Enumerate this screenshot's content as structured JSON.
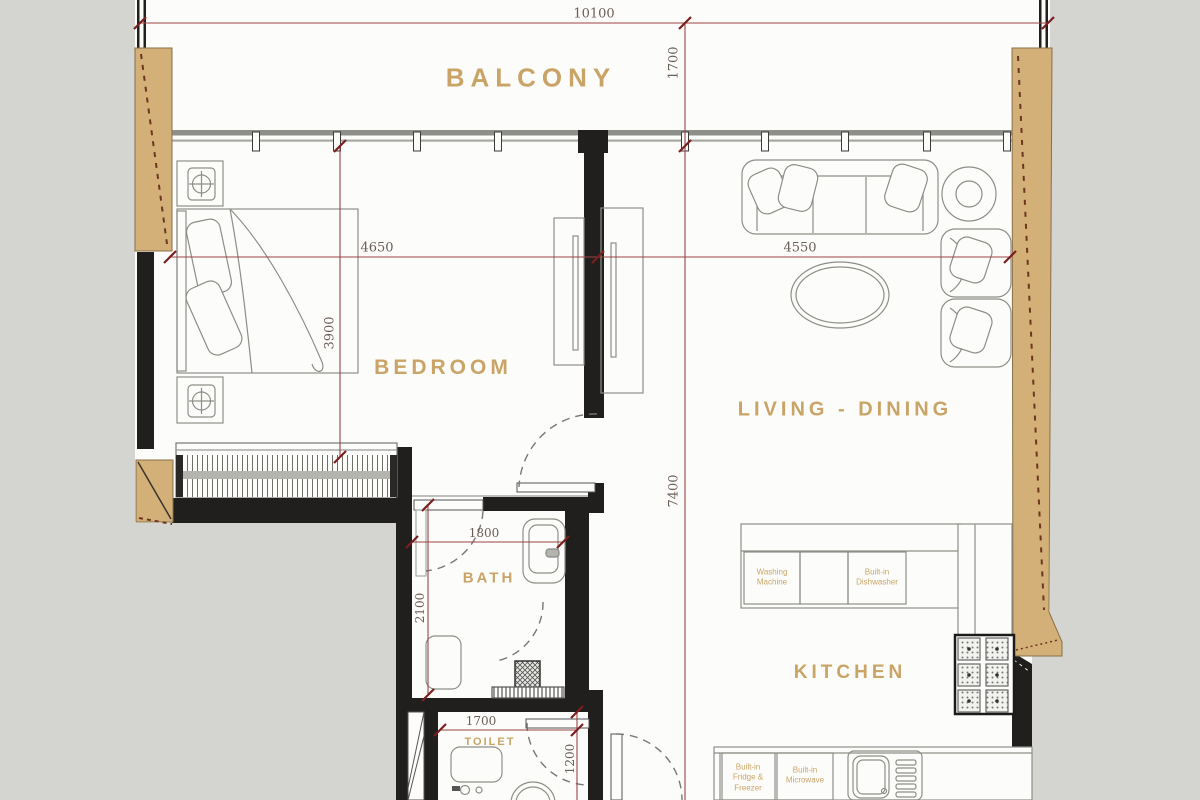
{
  "plan": {
    "rooms": {
      "balcony": "BALCONY",
      "bedroom": "BEDROOM",
      "living_dining": "LIVING - DINING",
      "bath": "BATH",
      "toilet": "TOILET",
      "kitchen": "KITCHEN"
    },
    "dimensions": {
      "overall_width": "10100",
      "balcony_depth": "1700",
      "bedroom_width": "4650",
      "bedroom_depth": "3900",
      "living_width": "4550",
      "unit_depth": "7400",
      "bath_width": "1800",
      "bath_depth": "2100",
      "toilet_width": "1700",
      "toilet_depth": "1200"
    },
    "appliances": {
      "washing_machine": "Washing Machine",
      "dishwasher": "Built-in Dishwasher",
      "fridge_freezer": "Built-in Fridge & Freezer",
      "microwave": "Built-in Microwave"
    },
    "colors": {
      "background": "#d4d4d0",
      "paper": "#fcfcfa",
      "wall_black": "#211f1d",
      "wood_tan": "#d2b078",
      "label_gold": "#c9a466",
      "dimension_red": "#9c4444",
      "dimension_tick": "#7a1f1f",
      "dimension_text": "#6b5d58",
      "furniture_gray": "#8e8e88"
    }
  }
}
